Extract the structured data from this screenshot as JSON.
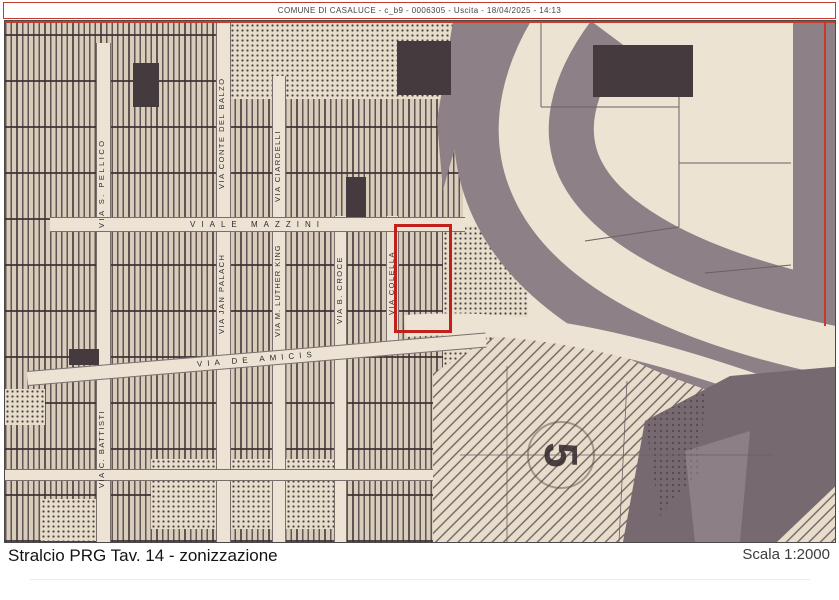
{
  "header": {
    "text": "COMUNE DI CASALUCE - c_b9 - 0006305 - Uscita - 18/04/2025 - 14:13",
    "border_color": "#c43b2b"
  },
  "map": {
    "streets": {
      "viale_mazzini": "VIALE MAZZINI",
      "via_s_pellico": "VIA S. PELLICO",
      "via_conte_del_balzo": "VIA CONTE DEL BALZO",
      "via_ciardelli": "VIA CIARDELLI",
      "via_jan_palach": "VIA JAN PALACH",
      "via_m_luther_king": "VIA M. LUTHER KING",
      "via_b_croce": "VIA B. CROCE",
      "via_colella": "VIA COLELLA",
      "via_de_amicis": "VIA DE AMICIS",
      "via_c_battisti": "VIA C. BATTISTI"
    },
    "zone_label": "5",
    "highlight_color": "#c2201a",
    "paper_color": "#ece3d3",
    "band_color": "#8d8086"
  },
  "footer": {
    "title": "Stralcio PRG Tav. 14 - zonizzazione",
    "scale": "Scala 1:2000"
  }
}
